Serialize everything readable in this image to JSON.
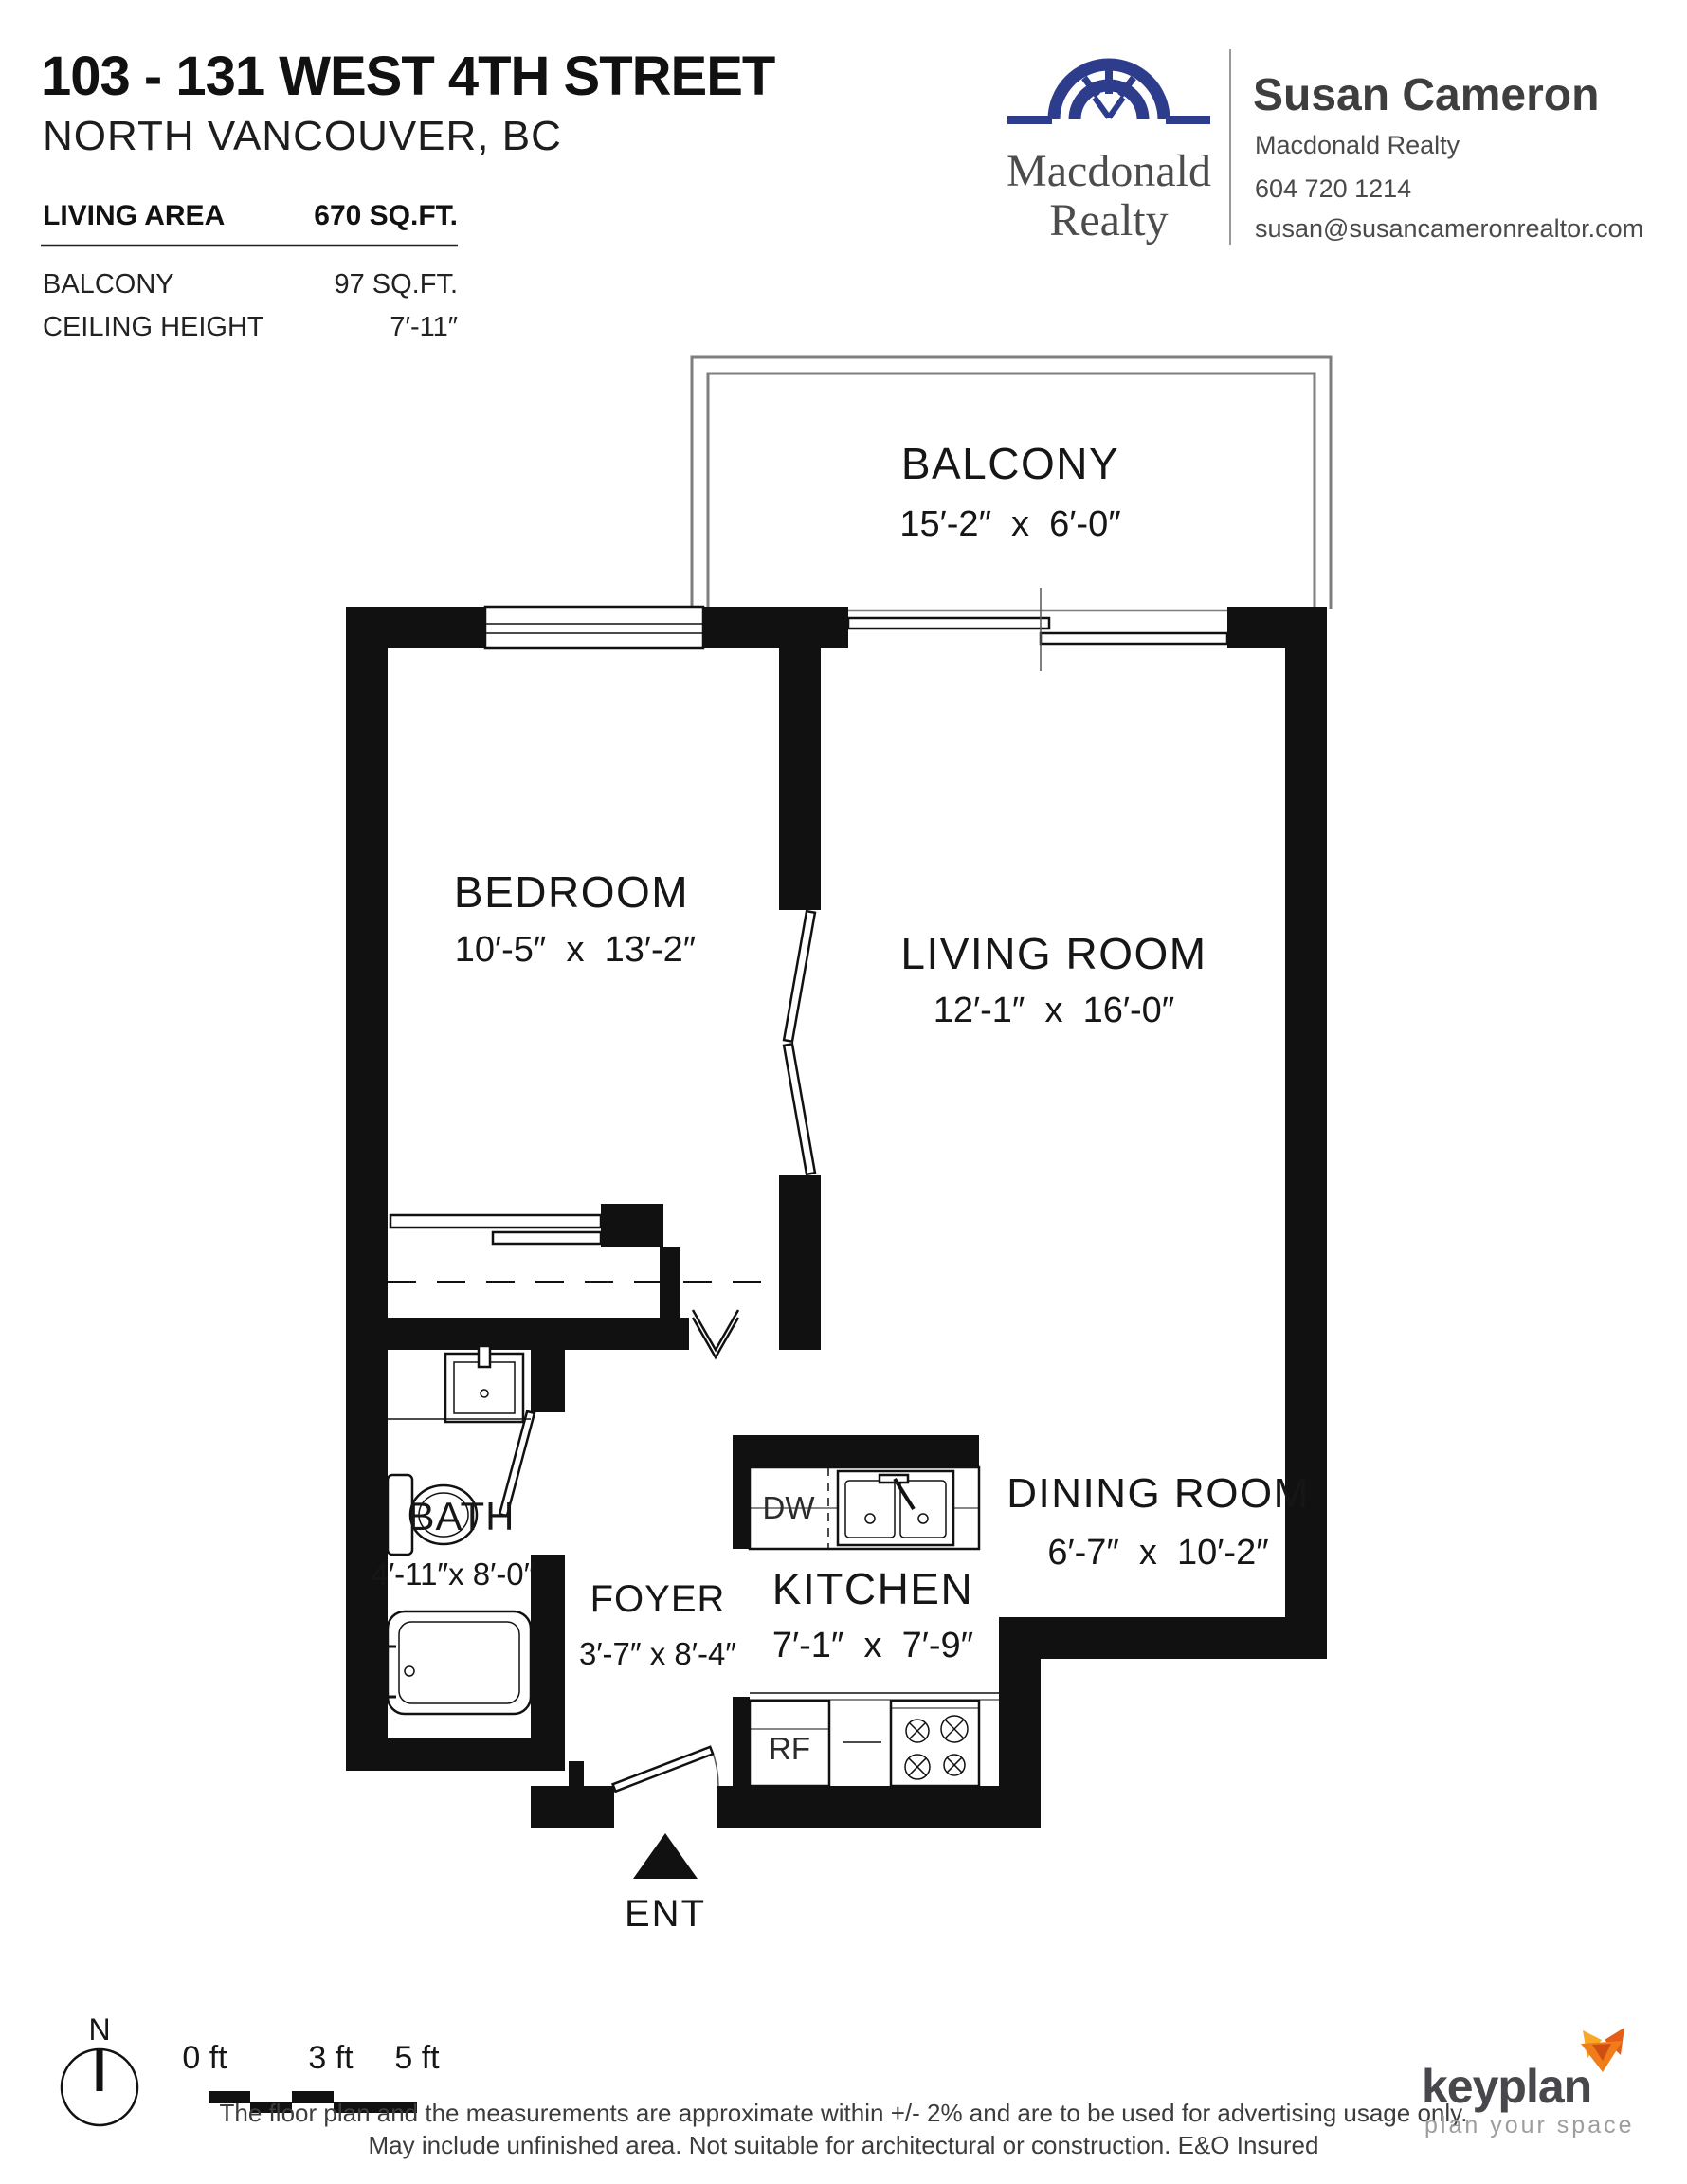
{
  "header": {
    "address": "103 - 131 WEST 4TH STREET",
    "city": "NORTH VANCOUVER, BC",
    "stats": [
      {
        "label": "LIVING AREA",
        "value": "670 SQ.FT."
      },
      {
        "label": "BALCONY",
        "value": "97 SQ.FT."
      },
      {
        "label": "CEILING HEIGHT",
        "value": "7′-11″"
      }
    ],
    "brand": {
      "name_line1": "Macdonald",
      "name_line2": "Realty"
    },
    "agent": {
      "name": "Susan Cameron",
      "company": "Macdonald Realty",
      "phone": "604 720 1214",
      "email": "susan@susancameronrealtor.com"
    }
  },
  "plan": {
    "balcony": {
      "name": "BALCONY",
      "dims": "15′-2″  x  6′-0″"
    },
    "bedroom": {
      "name": "BEDROOM",
      "dims": "10′-5″  x  13′-2″"
    },
    "living": {
      "name": "LIVING ROOM",
      "dims": "12′-1″  x  16′-0″"
    },
    "bath": {
      "name": "BATH",
      "dims": "4′-11″x 8′-0″"
    },
    "foyer": {
      "name": "FOYER",
      "dims": "3′-7″ x 8′-4″"
    },
    "kitchen": {
      "name": "KITCHEN",
      "dims": "7′-1″  x  7′-9″"
    },
    "dining": {
      "name": "DINING ROOM",
      "dims": "6′-7″  x  10′-2″"
    },
    "labels": {
      "dishwasher": "DW",
      "fridge": "RF",
      "entrance": "ENT"
    }
  },
  "footer": {
    "compass": "N",
    "scale_ticks": [
      "0 ft",
      "3 ft",
      "5 ft"
    ],
    "disclaimer1": "The floor plan and the measurements are approximate within +/- 2% and are to be used for advertising usage only.",
    "disclaimer2": "May include unfinished area. Not suitable for architectural or construction. E&O Insured",
    "keyplan": {
      "wordmark": "keyplan",
      "tagline": "plan your space"
    }
  },
  "colors": {
    "brand_blue": "#2e3c8c",
    "ink": "#111111",
    "fox_orange": "#ef7d1a",
    "keyplan_gray": "#47474c"
  }
}
